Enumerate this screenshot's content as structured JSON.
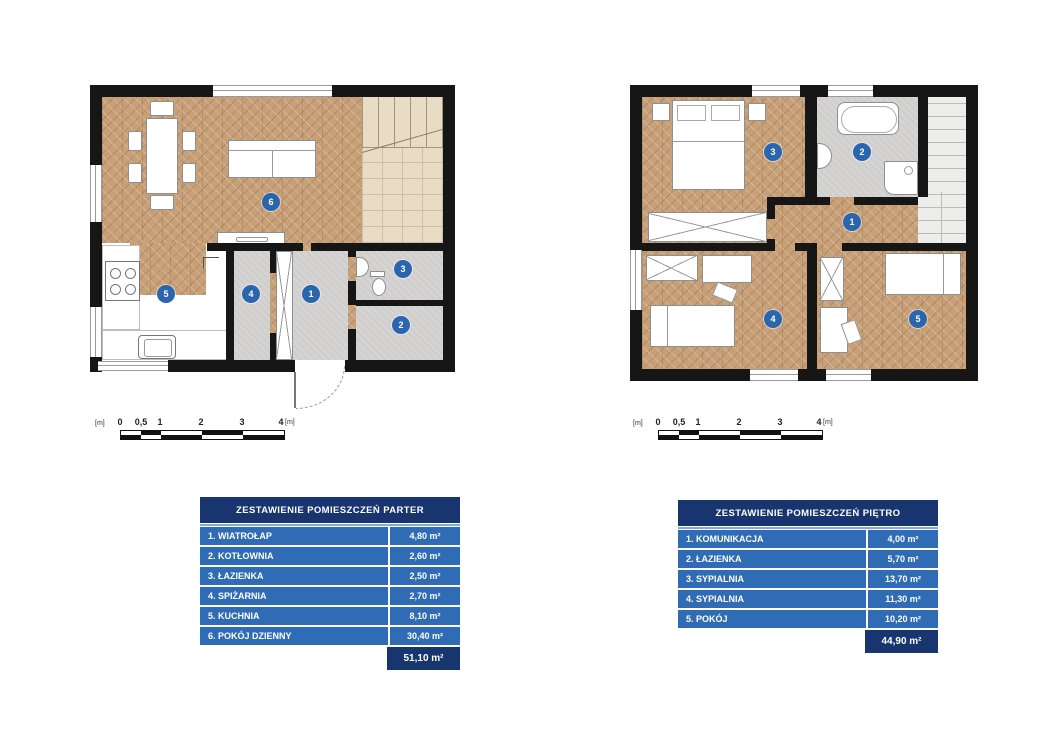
{
  "plans": {
    "ground": {
      "markers": [
        "1",
        "2",
        "3",
        "4",
        "5",
        "6"
      ]
    },
    "upper": {
      "markers": [
        "1",
        "2",
        "3",
        "4",
        "5"
      ]
    }
  },
  "scalebar": {
    "unit": "[m]",
    "ticks": [
      "0",
      "0,5",
      "1",
      "2",
      "3",
      "4"
    ],
    "end_unit": "[m]"
  },
  "tables": {
    "parter": {
      "title": "ZESTAWIENIE POMIESZCZEŃ PARTER",
      "rows": [
        {
          "label": "1. WIATROŁAP",
          "area": "4,80 m²"
        },
        {
          "label": "2. KOTŁOWNIA",
          "area": "2,60 m²"
        },
        {
          "label": "3. ŁAZIENKA",
          "area": "2,50 m²"
        },
        {
          "label": "4. SPIŻARNIA",
          "area": "2,70 m²"
        },
        {
          "label": "5. KUCHNIA",
          "area": "8,10 m²"
        },
        {
          "label": "6. POKÓJ DZIENNY",
          "area": "30,40 m²"
        }
      ],
      "total": "51,10 m²"
    },
    "pietro": {
      "title": "ZESTAWIENIE POMIESZCZEŃ PIĘTRO",
      "rows": [
        {
          "label": "1. KOMUNIKACJA",
          "area": "4,00 m²"
        },
        {
          "label": "2. ŁAZIENKA",
          "area": "5,70 m²"
        },
        {
          "label": "3. SYPIALNIA",
          "area": "13,70 m²"
        },
        {
          "label": "4. SYPIALNIA",
          "area": "11,30 m²"
        },
        {
          "label": "5. POKÓJ",
          "area": "10,20 m²"
        }
      ],
      "total": "44,90 m²"
    }
  },
  "colors": {
    "marker_blue": "#2a65ae",
    "table_header_navy": "#18356f",
    "table_row_blue": "#2f6cb5",
    "wood_floor": "#c8a078",
    "concrete_floor": "#d5d4d2",
    "wall_black": "#161616"
  }
}
